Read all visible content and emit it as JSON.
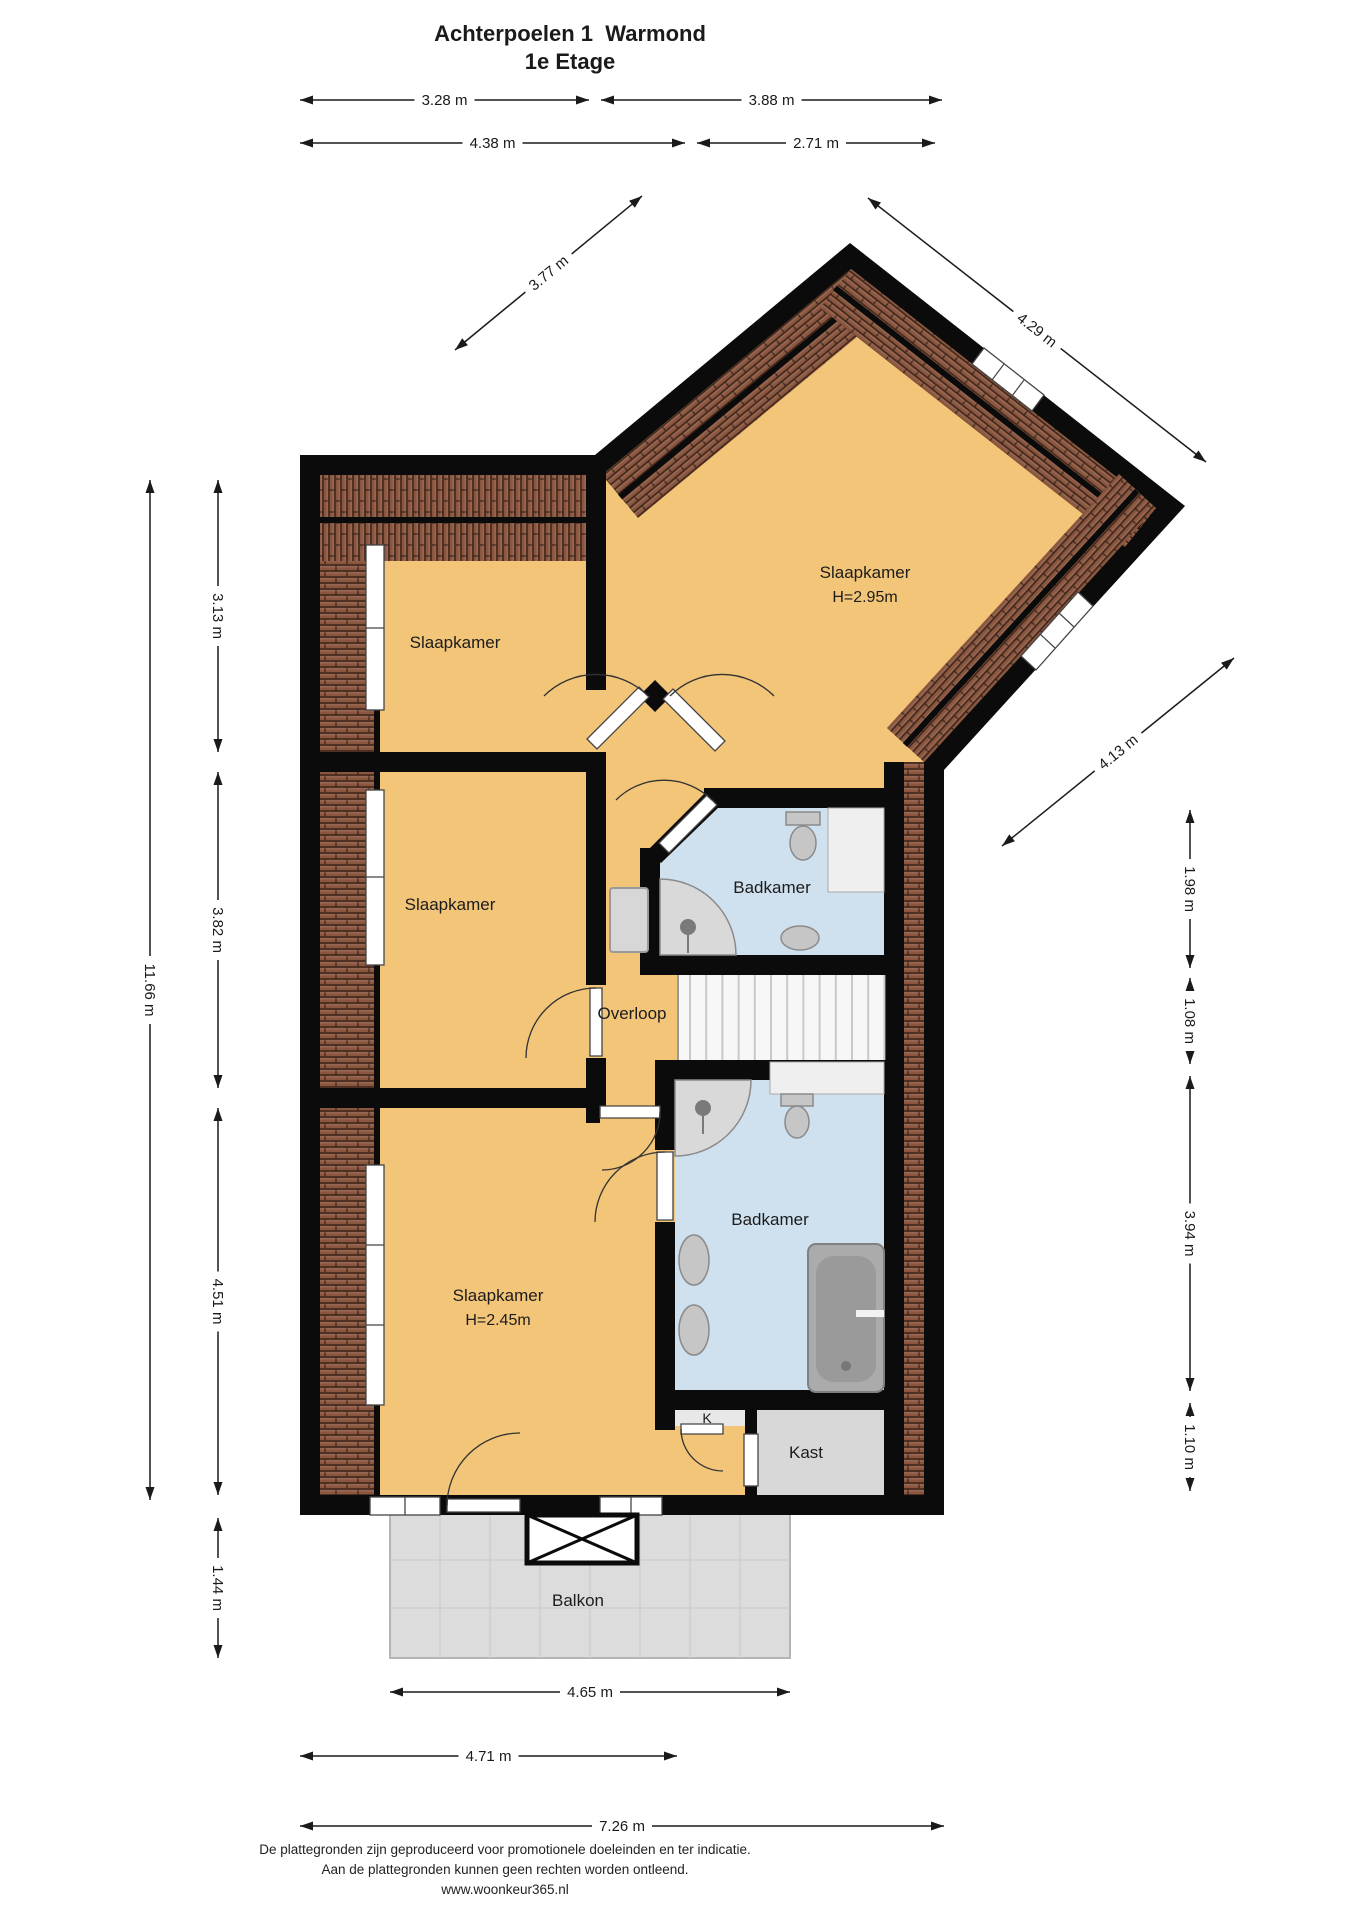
{
  "title": {
    "line1": "Achterpoelen 1  Warmond",
    "line2": "1e Etage"
  },
  "rooms": [
    {
      "id": "slaapkamer-noordwest",
      "label": "Slaapkamer",
      "note": ""
    },
    {
      "id": "slaapkamer-west",
      "label": "Slaapkamer",
      "note": ""
    },
    {
      "id": "slaapkamer-noordoost",
      "label": "Slaapkamer",
      "note": "H=2.95m"
    },
    {
      "id": "badkamer-boven",
      "label": "Badkamer",
      "note": ""
    },
    {
      "id": "overloop",
      "label": "Overloop",
      "note": ""
    },
    {
      "id": "badkamer-onder",
      "label": "Badkamer",
      "note": ""
    },
    {
      "id": "slaapkamer-zuid",
      "label": "Slaapkamer",
      "note": "H=2.45m"
    },
    {
      "id": "k-kast",
      "label": "K",
      "note": ""
    },
    {
      "id": "kast",
      "label": "Kast",
      "note": ""
    },
    {
      "id": "balkon",
      "label": "Balkon",
      "note": ""
    }
  ],
  "dimensions": {
    "top": [
      {
        "label": "3.28 m"
      },
      {
        "label": "3.88 m"
      },
      {
        "label": "4.38 m"
      },
      {
        "label": "2.71 m"
      }
    ],
    "left": [
      {
        "label": "11.66 m"
      },
      {
        "label": "3.13 m"
      },
      {
        "label": "3.82 m"
      },
      {
        "label": "4.51 m"
      },
      {
        "label": "1.44 m"
      }
    ],
    "right": [
      {
        "label": "1.98 m"
      },
      {
        "label": "1.08 m"
      },
      {
        "label": "3.94 m"
      },
      {
        "label": "1.10 m"
      }
    ],
    "diagonal": [
      {
        "label": "3.77 m"
      },
      {
        "label": "4.29 m"
      },
      {
        "label": "4.13 m"
      }
    ],
    "bottom": [
      {
        "label": "4.65 m"
      },
      {
        "label": "4.71 m"
      },
      {
        "label": "7.26 m"
      }
    ]
  },
  "footer": {
    "line1": "De plattegronden zijn geproduceerd voor promotionele doeleinden en ter indicatie.",
    "line2": "Aan de plattegronden kunnen geen rechten worden ontleend.",
    "line3": "www.woonkeur365.nl"
  },
  "colors": {
    "wall": "#0b0b0b",
    "floor": "#f2c578",
    "bath_floor": "#cfe0ee",
    "tile": "#8a563e",
    "balcony": "#dcdcdc",
    "closet_floor": "#d8d8d8",
    "fixture": "#c6c6c6"
  }
}
